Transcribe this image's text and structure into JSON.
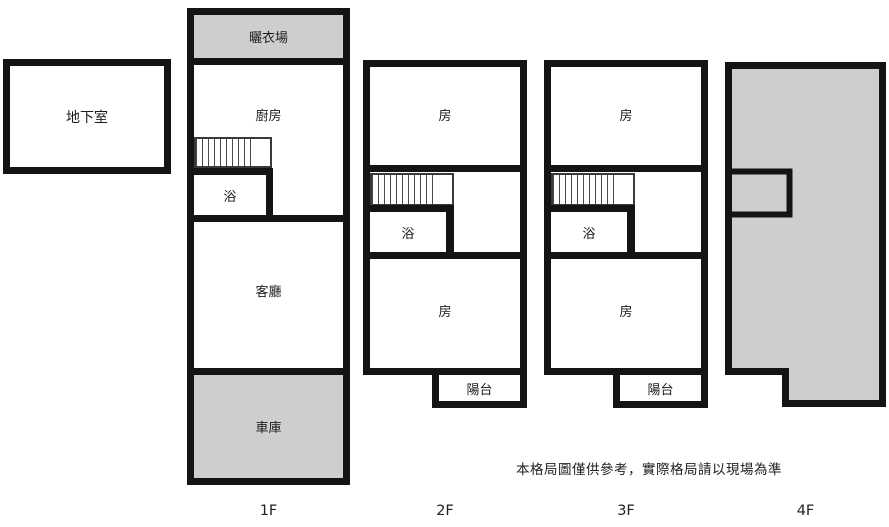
{
  "basement": {
    "label": "地下室"
  },
  "f1": {
    "floor_label": "1F",
    "laundry": "曬衣場",
    "kitchen": "廚房",
    "bath": "浴",
    "living": "客廳",
    "garage": "車庫"
  },
  "f2": {
    "floor_label": "2F",
    "room_top": "房",
    "bath": "浴",
    "room_bottom": "房",
    "balcony": "陽台"
  },
  "f3": {
    "floor_label": "3F",
    "room_top": "房",
    "bath": "浴",
    "room_bottom": "房",
    "balcony": "陽台"
  },
  "f4": {
    "floor_label": "4F"
  },
  "disclaimer": "本格局圖僅供參考，實際格局請以現場為準",
  "colors": {
    "wall": "#141414",
    "shaded": "#cecece",
    "background": "#ffffff",
    "text": "#1c1c1c",
    "stair_line": "#4a4a4a"
  }
}
